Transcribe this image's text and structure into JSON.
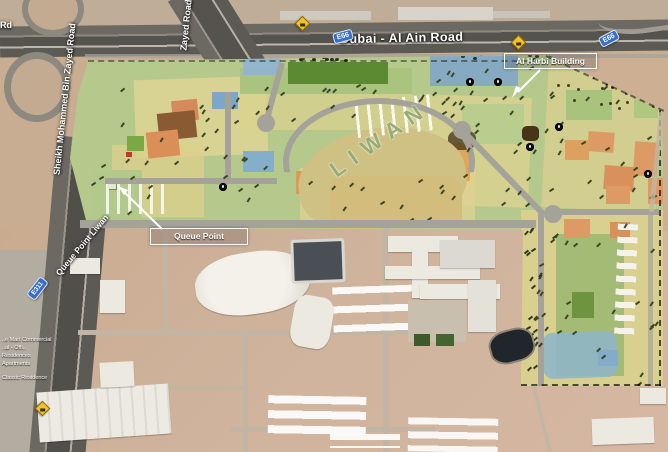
{
  "map": {
    "description": "Annotated satellite map of Liwan / Queue Point development beside Dubai - Al Ain Road",
    "roads": {
      "dubai_al_ain_road": "Dubai - Al Ain Road",
      "sheikh_mohammed_bin_zayed_road": "Sheikh Mohammed Bin Zayed Road",
      "zayed_road_fragment": "Zayed Road",
      "rd_fragment": "Rd",
      "queue_point_liwan_road": "Queue Point Liwan"
    },
    "route_shields": {
      "e66": "E66",
      "e311": "E311",
      "yellow_diamond_label": ""
    },
    "callouts": {
      "al_harbi_building": "Al Harbi Building",
      "queue_point": "Queue Point"
    },
    "area_labels": {
      "liwan": "LIWAN"
    },
    "small_place_labels": [
      "..e Mart Commercial",
      "..al - Offi..",
      "Residences",
      "Apartments",
      "Classic Residence"
    ],
    "poi_markers": {
      "count": 6,
      "glyph": ""
    },
    "palette": {
      "sand": "#c9ad92",
      "sand_bottom": "#cfb39c",
      "highway": "#55534d",
      "site_green": "#b5c98c",
      "parcel_yellow": "#ddd292",
      "parcel_orange": "#dd9a64",
      "parcel_brown": "#8a5a33",
      "parcel_blue": "#84abc9",
      "parcel_dark_green": "#5c8a33",
      "crescent_khaki": "#cfc083",
      "shield_blue": "#3a6fc8",
      "shield_yellow": "#f2c12e",
      "callout_border": "#ffffff"
    }
  }
}
